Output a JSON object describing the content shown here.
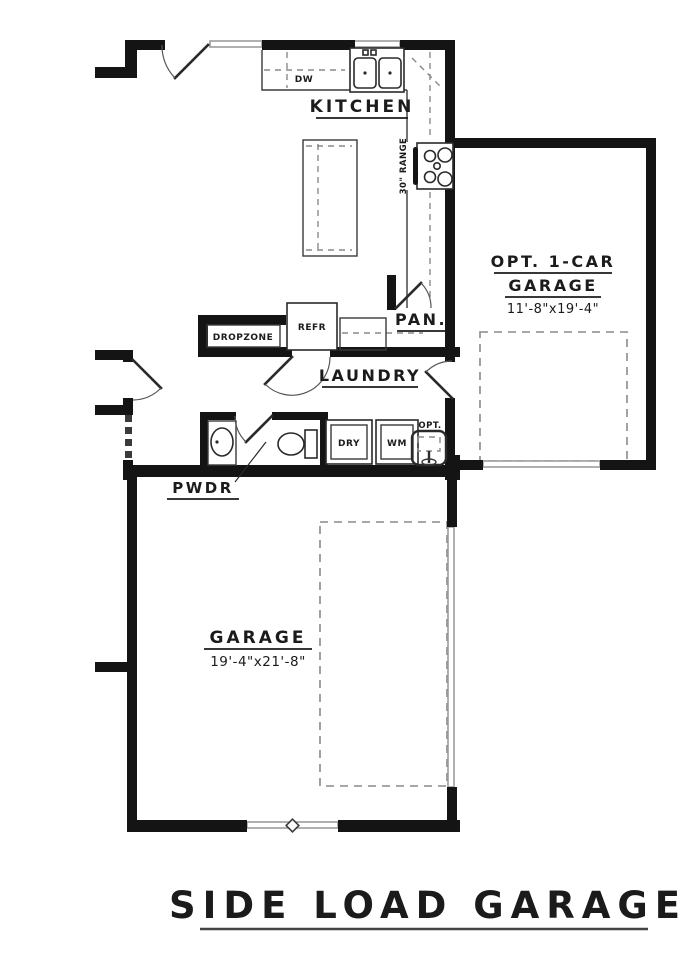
{
  "title": "SIDE LOAD GARAGE",
  "rooms": {
    "kitchen": {
      "label": "KITCHEN"
    },
    "laundry": {
      "label": "LAUNDRY"
    },
    "pantry": {
      "label": "PAN."
    },
    "powder": {
      "label": "PWDR"
    },
    "dropzone": {
      "label": "DROPZONE"
    },
    "opt_garage": {
      "line1": "OPT. 1-CAR",
      "line2": "GARAGE",
      "dims": "11'-8\"x19'-4\""
    },
    "garage": {
      "label": "GARAGE",
      "dims": "19'-4\"x21'-8\""
    }
  },
  "appliances": {
    "dishwasher": "DW",
    "range": "30\" RANGE",
    "refrigerator": "REFR",
    "dryer": "DRY",
    "washer": "WM",
    "opt_sink": "OPT."
  },
  "colors": {
    "wall": "#141414",
    "line": "#3a3a3a",
    "dash": "#8a8a8a",
    "window": "#9c9c9c",
    "background": "#ffffff"
  }
}
